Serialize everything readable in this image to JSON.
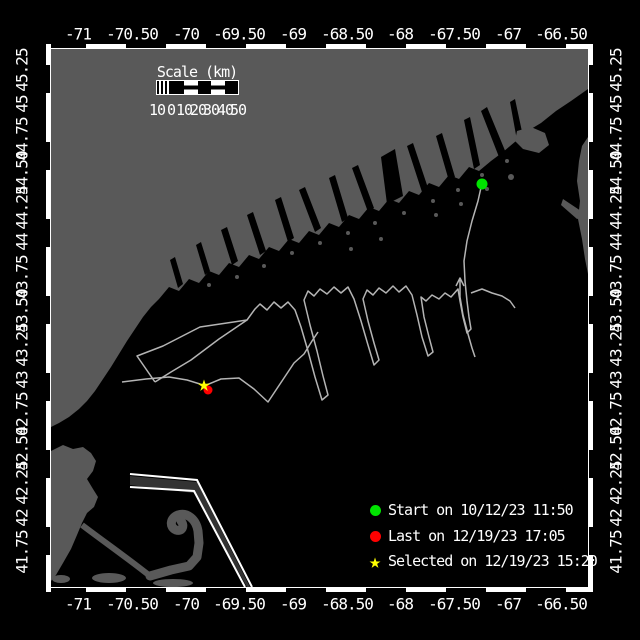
{
  "map": {
    "colors": {
      "land": "#595959",
      "ocean": "#000000",
      "track": "#b4b4b4",
      "frame": "#ffffff",
      "start_green": "#00e400",
      "last_red": "#ff0000",
      "selected_yellow": "#ffff00",
      "shipping_lane": "#ffffff"
    },
    "markers": [
      {
        "id": "last-position-marker",
        "shape": "circle",
        "color": "#ff0000",
        "x": 208,
        "y": 390,
        "size": 9
      },
      {
        "id": "start-position-marker",
        "shape": "circle",
        "color": "#00e400",
        "x": 482,
        "y": 184,
        "size": 11
      },
      {
        "id": "selected-position-marker",
        "shape": "star",
        "color": "#ffff00",
        "x": 204,
        "y": 386,
        "size": 22
      }
    ]
  },
  "axes": {
    "lon": {
      "labels": [
        "-71",
        "-70.50",
        "-70",
        "-69.50",
        "-69",
        "-68.50",
        "-68",
        "-67.50",
        "-67",
        "-66.50"
      ],
      "x": [
        78,
        132,
        186,
        239,
        293,
        347,
        400,
        454,
        508,
        561
      ],
      "top_y": 34,
      "bottom_y": 604
    },
    "lat": {
      "labels": [
        "45.25",
        "45",
        "44.75",
        "44.50",
        "44.25",
        "44",
        "43.75",
        "43.50",
        "43.25",
        "43",
        "42.75",
        "42.50",
        "42.25",
        "42",
        "41.75"
      ],
      "y": [
        70,
        104,
        139,
        173,
        208,
        242,
        277,
        311,
        345,
        380,
        414,
        449,
        483,
        518,
        552
      ],
      "left_x": 22,
      "right_x": 616
    }
  },
  "scale_bar": {
    "title": "Scale (km)",
    "ticks": [
      "10",
      "0",
      "10",
      "20",
      "30",
      "40",
      "50"
    ],
    "tick_x": [
      157,
      171,
      184,
      198,
      211,
      225,
      238
    ]
  },
  "legend": {
    "x": 362,
    "row_y": [
      502,
      528,
      553
    ],
    "items": [
      {
        "label": "Start on 10/12/23 11:50",
        "marker": "circle",
        "color": "#00e400"
      },
      {
        "label": "Last on 12/19/23 17:05",
        "marker": "circle",
        "color": "#ff0000"
      },
      {
        "label": "Selected on 12/19/23 15:20",
        "marker": "star",
        "color": "#ffff00"
      }
    ]
  }
}
